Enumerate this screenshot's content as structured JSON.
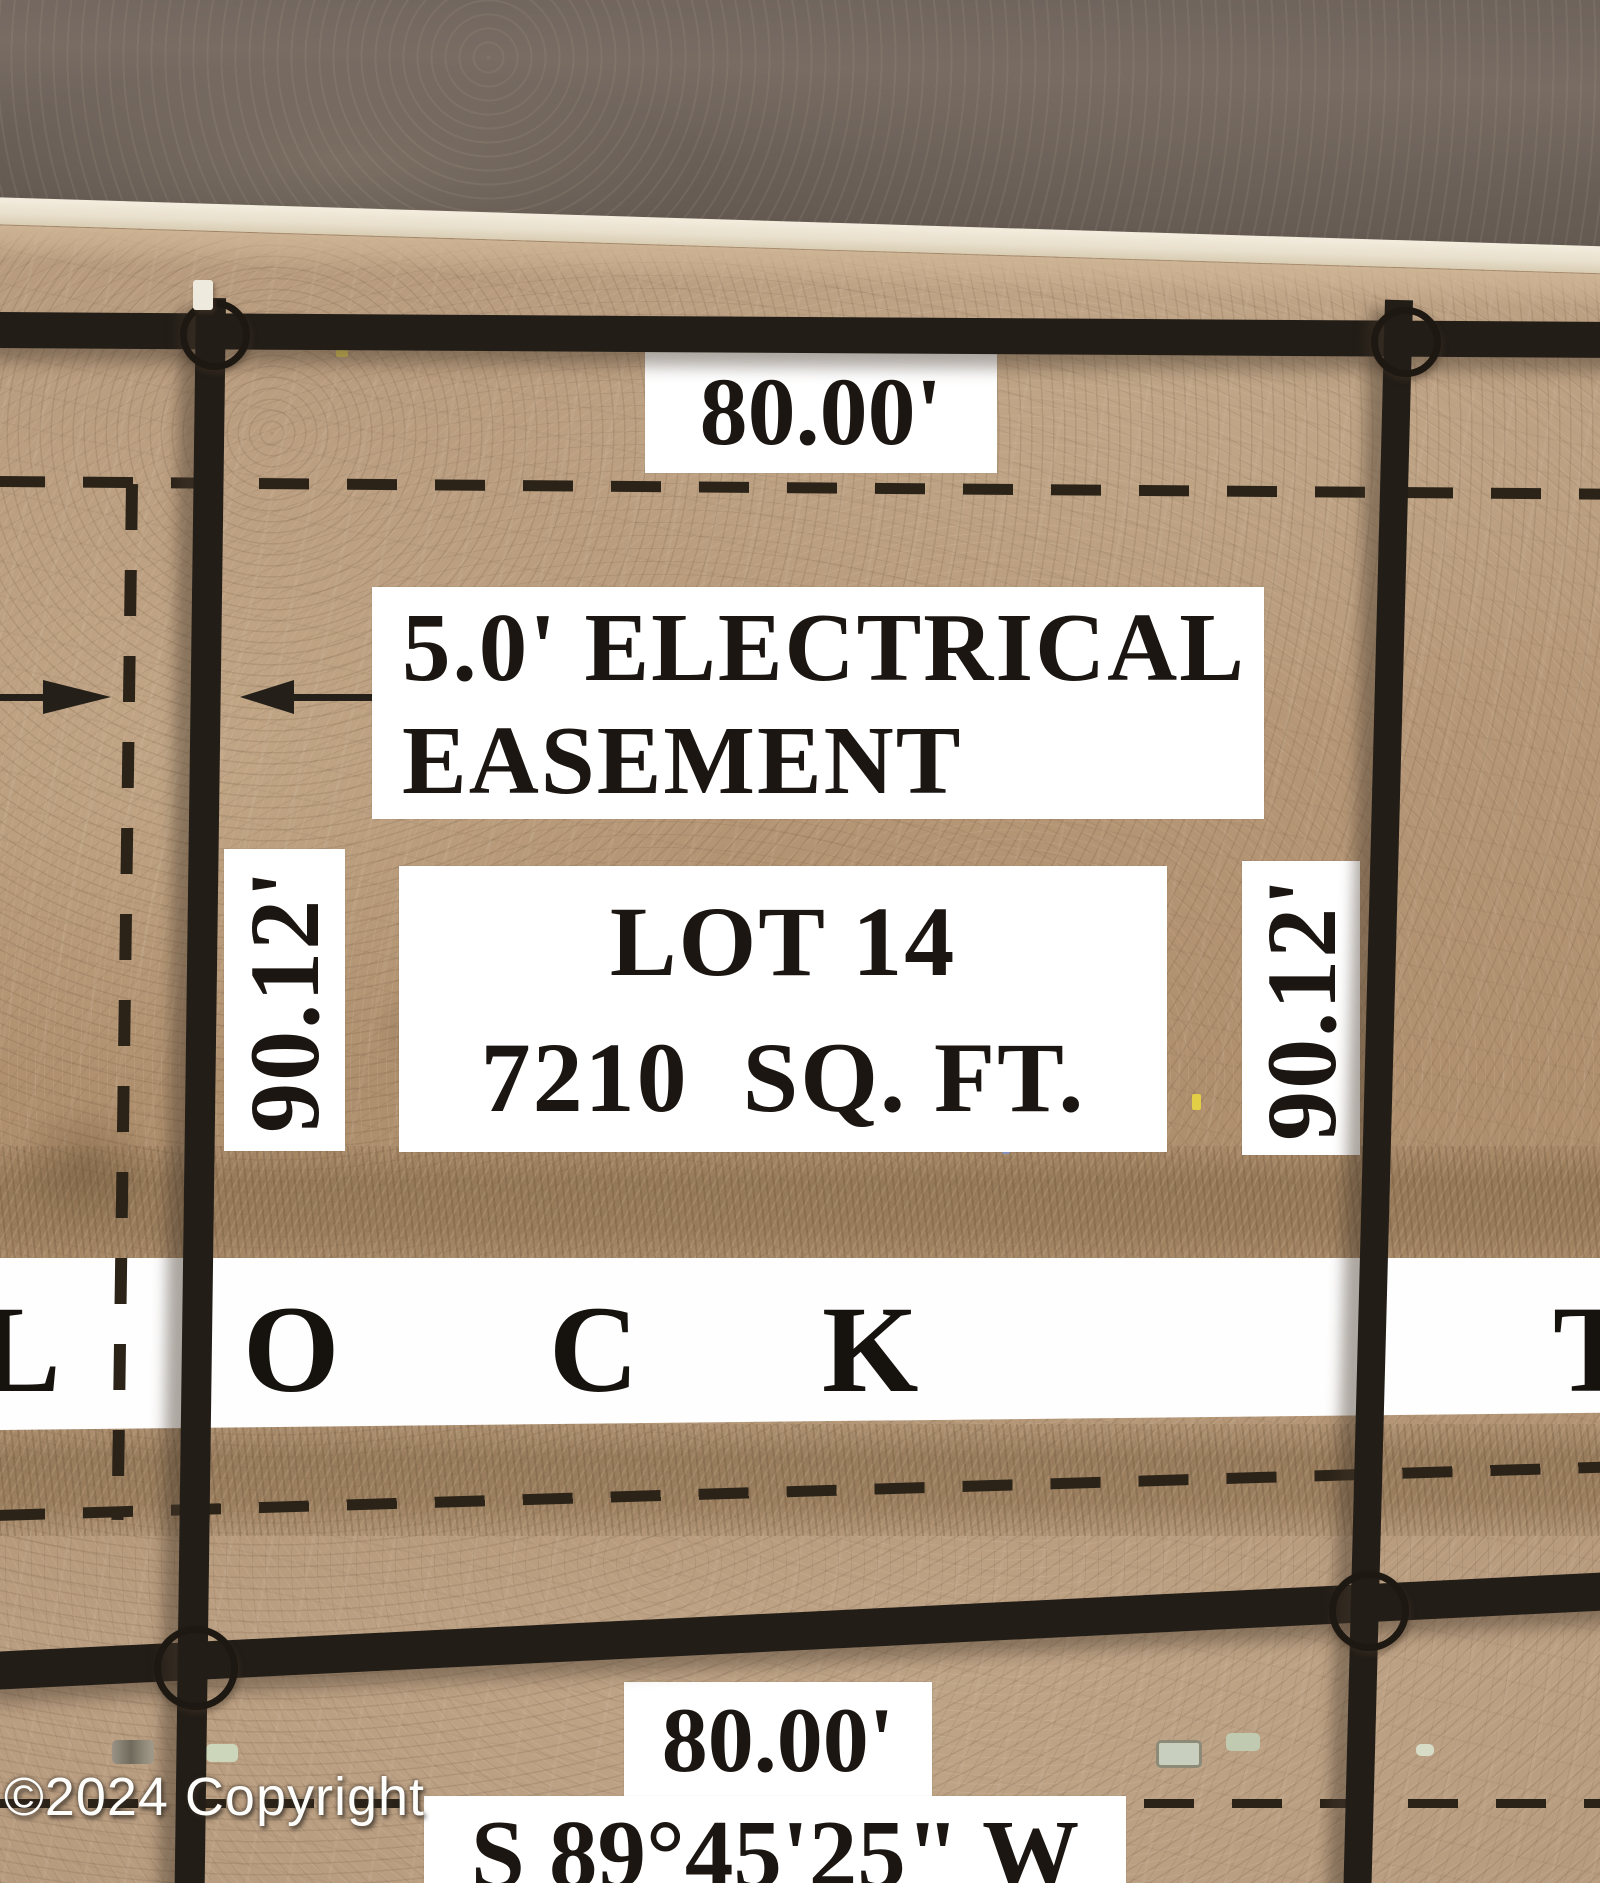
{
  "map": {
    "top_width": "80.00'",
    "easement_label_line1": "5.0' ELECTRICAL",
    "easement_label_line2": "EASEMENT",
    "lot_name": "LOT 14",
    "lot_area": "7210  SQ. FT.",
    "depth_left": "90.12'",
    "depth_right": "90.12'",
    "block_letters": {
      "l": "L",
      "o": "O",
      "c": "C",
      "k": "K",
      "t": "T"
    },
    "bottom_width": "80.00'",
    "bottom_bearing": "S 89°45'25\" W",
    "copyright": "©2024 Copyright",
    "colors": {
      "line": "#1e1812",
      "label_bg": "#ffffff",
      "label_text": "#1b1611",
      "dirt": "#b3977a",
      "asphalt": "#6f655e",
      "curb": "#ece4d4"
    }
  }
}
